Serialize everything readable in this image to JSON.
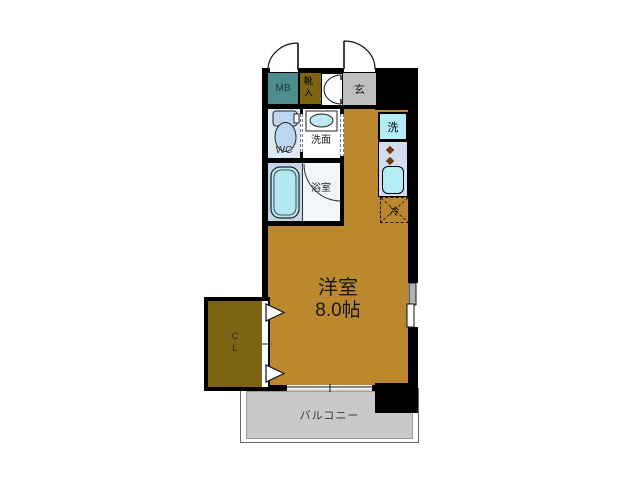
{
  "document": {
    "kind": "japanese-apartment-floor-plan"
  },
  "labels": {
    "meter_box": "MB",
    "shoe_box": "靴入",
    "entrance": "玄",
    "toilet": "WC",
    "washroom": "洗面",
    "bathroom": "浴室",
    "washer": "洗",
    "fridge": "冷",
    "closet": "C\nL",
    "main_room_name": "洋室",
    "main_room_size": "8.0帖",
    "balcony": "バルコニー"
  },
  "colors": {
    "wall": "#000000",
    "main_room": "#bc882e",
    "meter_box": "#4d8d8d",
    "shoe_box": "#7c6414",
    "closet": "#7c6414",
    "entrance": "#bfbfbf",
    "balcony": "#c9c9c9",
    "fixture_cyan": "#b5ebf4",
    "wc_floor": "#dfe9f5",
    "bath_floor": "#c6d6ea",
    "kitchen_counter": "#d2ddf0",
    "toilet_fill": "#bdd7f0",
    "burner": "#733c12"
  },
  "icons": [
    "door-swing-arc",
    "double-door-arc",
    "toilet-icon",
    "washbasin-icon",
    "bathtub-icon",
    "washing-machine-box",
    "kitchen-sink-icon",
    "stove-burner-icon",
    "fridge-dashed-box",
    "window-symbol",
    "sliding-door-symbol",
    "closet-door-arrow"
  ]
}
